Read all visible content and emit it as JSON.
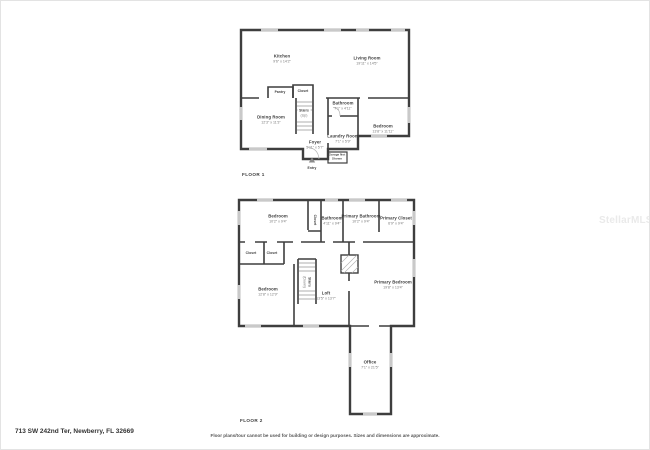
{
  "page": {
    "address": "713 SW 242nd Ter, Newberry, FL 32669",
    "disclaimer": "Floor plans/tour cannot be used for building or design purposes. Sizes and dimensions are approximate.",
    "watermark": "StellarMLS",
    "wall_color": "#3e3e3e",
    "window_color": "#c9c9c9"
  },
  "floor1": {
    "label": "FLOOR 1",
    "rooms": {
      "kitchen": {
        "name": "Kitchen",
        "dims": "9'6\" x 14'2\""
      },
      "living": {
        "name": "Living Room",
        "dims": "19'11\" x 14'5\""
      },
      "pantry": {
        "name": "Pantry"
      },
      "closet": {
        "name": "Closet"
      },
      "stairs": {
        "name": "Stairs",
        "dims": "(Up)"
      },
      "bathroom": {
        "name": "Bathroom",
        "dims": "7'1\" x 4'11\""
      },
      "dining": {
        "name": "Dining Room",
        "dims": "12'3\" x 11'3\""
      },
      "bedroom": {
        "name": "Bedroom",
        "dims": "13'8\" x 11'11\""
      },
      "laundry": {
        "name": "Laundry Room",
        "dims": "7'1\" x 5'9\""
      },
      "foyer": {
        "name": "Foyer",
        "dims": "5'11\" x 5'7\""
      },
      "garage": {
        "name": "Garage Not Shown"
      },
      "entry": {
        "name": "Entry"
      }
    }
  },
  "floor2": {
    "label": "FLOOR 2",
    "rooms": {
      "bedroom1": {
        "name": "Bedroom",
        "dims": "10'2\" x 9'4\""
      },
      "closet_hall": {
        "name": "Closet"
      },
      "bathroom": {
        "name": "Bathroom",
        "dims": "4'11\" x 9'4\""
      },
      "primary_bath": {
        "name": "Primary Bathroom",
        "dims": "10'2\" x 9'4\""
      },
      "primary_closet": {
        "name": "Primary Closet",
        "dims": "6'9\" x 9'4\""
      },
      "closet_a": {
        "name": "Closet"
      },
      "closet_b": {
        "name": "Closet"
      },
      "stairs": {
        "name": "Stairs",
        "dims": "(Down)"
      },
      "bedroom2": {
        "name": "Bedroom",
        "dims": "12'8\" x 12'9\""
      },
      "loft": {
        "name": "Loft",
        "dims": "13'5\" x 13'7\""
      },
      "primary_bedroom": {
        "name": "Primary Bedroom",
        "dims": "19'8\" x 13'4\""
      },
      "office": {
        "name": "Office",
        "dims": "7'1\" x 21'5\""
      }
    }
  }
}
